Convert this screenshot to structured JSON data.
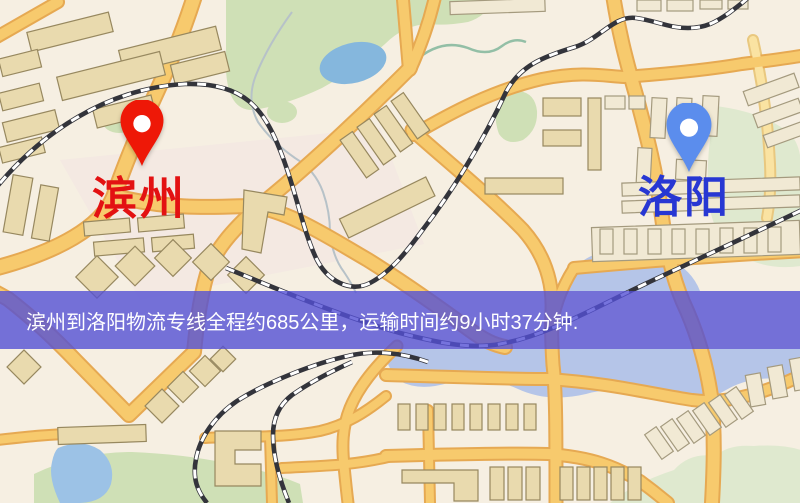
{
  "map": {
    "origin_marker": {
      "name": "滨州",
      "pin_color": "#ee1807",
      "label_color": "#e31112",
      "pin_style": "red-pin"
    },
    "destination_marker": {
      "name": "洛阳",
      "pin_color": "#5b8ded",
      "label_color": "#2737d3",
      "pin_style": "blue-pin"
    }
  },
  "banner": {
    "text": "滨州到洛阳物流专线全程约685公里，运输时间约9小时37分钟.",
    "background_color": "#5450d4",
    "text_color": "#ffffff"
  },
  "route": {
    "origin": "滨州",
    "destination": "洛阳",
    "distance": "约685公里",
    "duration": "约9小时37分钟"
  }
}
